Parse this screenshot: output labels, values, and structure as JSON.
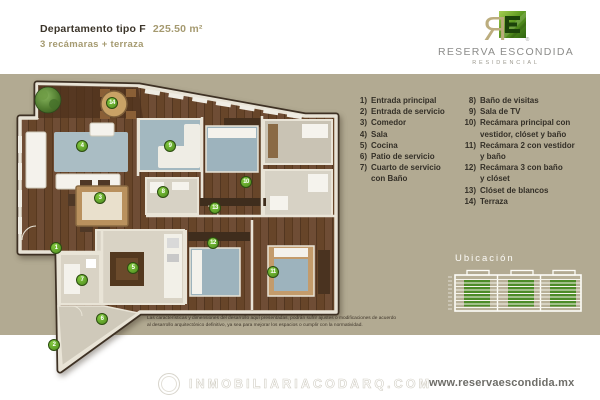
{
  "colors": {
    "beige": "#b2aa92",
    "gold": "#a59a70",
    "green-badge": "#4c8a1e",
    "green-building": "#4d8c28"
  },
  "header": {
    "title": "Departamento tipo F",
    "area": "225.50 m²",
    "subtitle": "3 recámaras + terraza"
  },
  "logo": {
    "mark_letter": "R",
    "name": "RESERVA ESCONDIDA",
    "tagline": "RESIDENCIAL",
    "registered": "®"
  },
  "legend": {
    "columns": [
      [
        {
          "num": "1)",
          "label": "Entrada principal"
        },
        {
          "num": "2)",
          "label": "Entrada de servicio"
        },
        {
          "num": "3)",
          "label": "Comedor"
        },
        {
          "num": "4)",
          "label": "Sala"
        },
        {
          "num": "5)",
          "label": "Cocina"
        },
        {
          "num": "6)",
          "label": "Patio de servicio"
        },
        {
          "num": "7)",
          "label": "Cuarto de servicio\ncon Baño"
        }
      ],
      [
        {
          "num": "8)",
          "label": "Baño de visitas"
        },
        {
          "num": "9)",
          "label": "Sala de TV"
        },
        {
          "num": "10)",
          "label": "Recámara principal con\nvestidor, clóset y baño"
        },
        {
          "num": "11)",
          "label": "Recámara 2 con vestidor\ny baño"
        },
        {
          "num": "12)",
          "label": "Recámara 3 con baño\ny clóset"
        },
        {
          "num": "13)",
          "label": "Clóset de blancos"
        },
        {
          "num": "14)",
          "label": "Terraza"
        }
      ]
    ]
  },
  "plan": {
    "badges": [
      {
        "n": "1",
        "x": 44,
        "y": 168
      },
      {
        "n": "2",
        "x": 42,
        "y": 265
      },
      {
        "n": "3",
        "x": 88,
        "y": 118
      },
      {
        "n": "4",
        "x": 70,
        "y": 66
      },
      {
        "n": "5",
        "x": 121,
        "y": 188
      },
      {
        "n": "6",
        "x": 90,
        "y": 239
      },
      {
        "n": "7",
        "x": 70,
        "y": 200
      },
      {
        "n": "8",
        "x": 151,
        "y": 112
      },
      {
        "n": "9",
        "x": 158,
        "y": 66
      },
      {
        "n": "10",
        "x": 234,
        "y": 102
      },
      {
        "n": "11",
        "x": 261,
        "y": 192
      },
      {
        "n": "12",
        "x": 201,
        "y": 163
      },
      {
        "n": "13",
        "x": 203,
        "y": 128
      },
      {
        "n": "14",
        "x": 100,
        "y": 23
      }
    ]
  },
  "ubicacion": {
    "title": "Ubicación"
  },
  "disclaimer": {
    "text": "Las características y dimensiones del desarrollo aquí presentadas, podrán sufrir ajustes o modificaciones de acuerdo\nal desarrollo arquitectónico definitivo, ya sea para mejorar los espacios o cumplir con la normatividad."
  },
  "footer": {
    "watermark": "INMOBILIARIACODARQ.COM",
    "website": "www.reservaescondida.mx"
  }
}
